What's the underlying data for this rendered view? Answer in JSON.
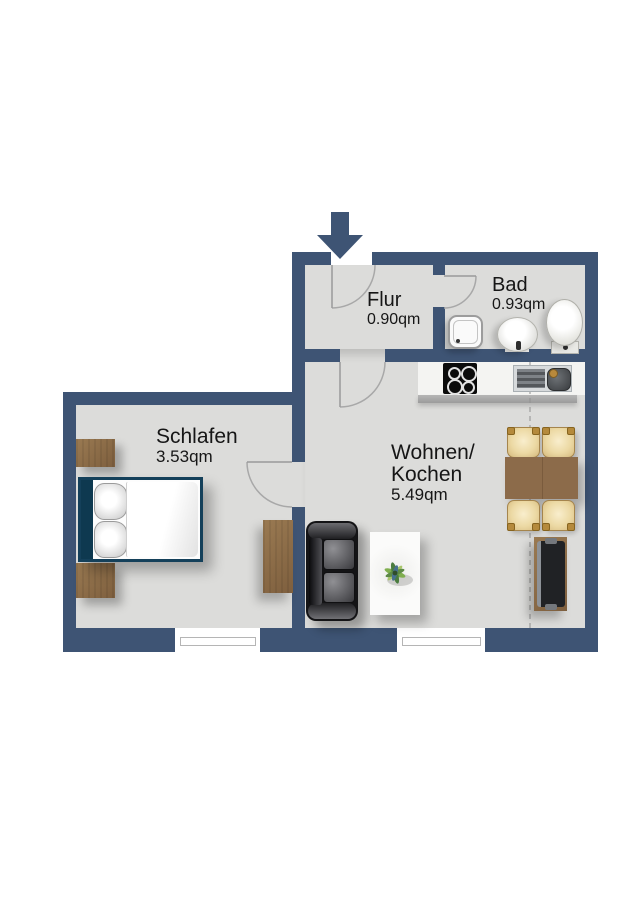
{
  "rooms": {
    "flur": {
      "name": "Flur",
      "area": "0.90qm"
    },
    "bad": {
      "name": "Bad",
      "area": "0.93qm"
    },
    "schlafen": {
      "name": "Schlafen",
      "area": "3.53qm"
    },
    "wohnen": {
      "name_line1": "Wohnen/",
      "name_line2": "Kochen",
      "area": "5.49qm"
    }
  },
  "colors": {
    "wall": "#3e5474",
    "floor": "#dcdcda",
    "wood": "#8c6b4a",
    "bed_frame": "#14405a",
    "chair_seat": "#ecd9a4",
    "tile_line": "#cfcfcd",
    "text": "#161616"
  }
}
